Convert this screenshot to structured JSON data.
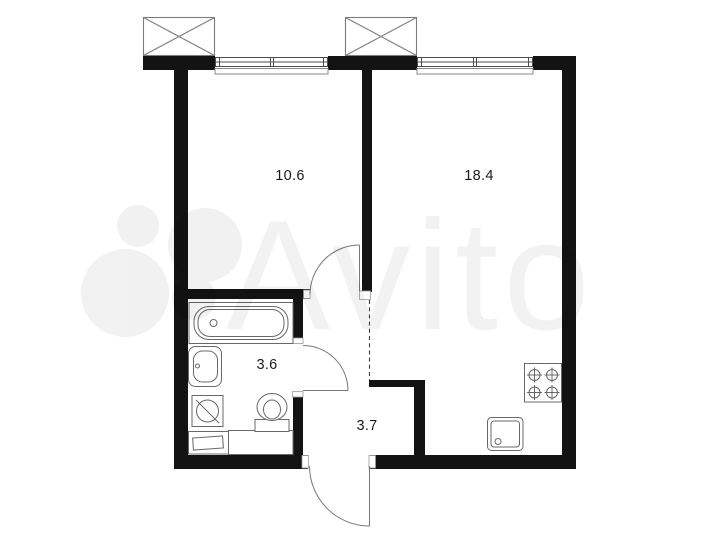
{
  "floor_plan": {
    "rooms": [
      {
        "name": "room",
        "area_label": "10.6"
      },
      {
        "name": "kitchen-living",
        "area_label": "18.4"
      },
      {
        "name": "bathroom",
        "area_label": "3.6"
      },
      {
        "name": "hallway",
        "area_label": "3.7"
      }
    ],
    "watermark_text": "Avito",
    "colors": {
      "wall": "#131313",
      "fixture_line": "#686868",
      "thin_line": "#7d7d7d",
      "label_text": "#1b1b1b",
      "watermark": "rgba(0,0,0,0.05)",
      "background": "#ffffff"
    }
  }
}
